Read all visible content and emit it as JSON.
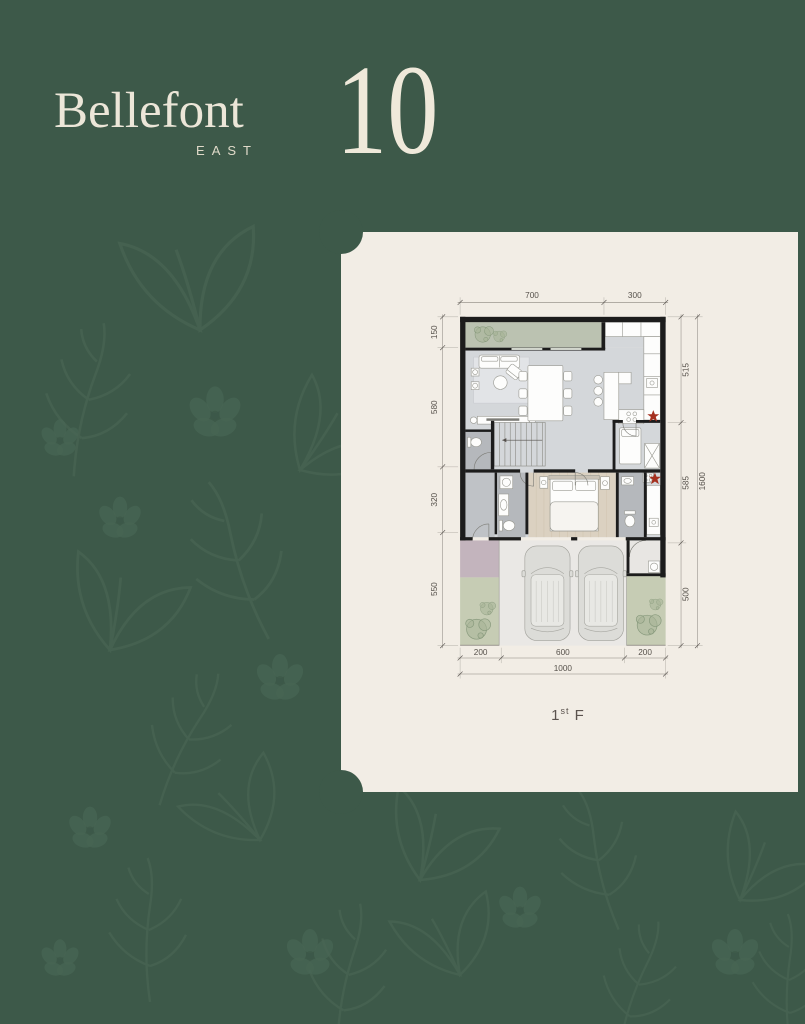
{
  "brand": {
    "name": "Bellefont",
    "region": "EAST",
    "unit_number": "10"
  },
  "card": {
    "floor_label": {
      "number": "1",
      "ordinal": "st",
      "suffix": "F"
    }
  },
  "plan": {
    "dims": {
      "top_700": "700",
      "top_300": "300",
      "left_150": "150",
      "left_580": "580",
      "left_320": "320",
      "left_550": "550",
      "right_515": "515",
      "right_585": "585",
      "right_500": "500",
      "right_1600": "1600",
      "bottom_200a": "200",
      "bottom_600": "600",
      "bottom_200b": "200",
      "bottom_1000": "1000"
    },
    "colors": {
      "page_background": "#3d5949",
      "card_background": "#f2ede5",
      "logo_cream": "#ece6d8",
      "wall": "#1c1c1c",
      "floor": "#d4d7da",
      "wood_floor": "#dbd1c1",
      "bath_floor": "#b5b8bc",
      "planter_green": "#bbc2b1",
      "garden_green": "#c6ccb4",
      "porch_mauve": "#c3b4bd",
      "garage_floor": "#eae8e5",
      "stove_star": "#a5301f",
      "dimension_text": "#57524c"
    }
  }
}
